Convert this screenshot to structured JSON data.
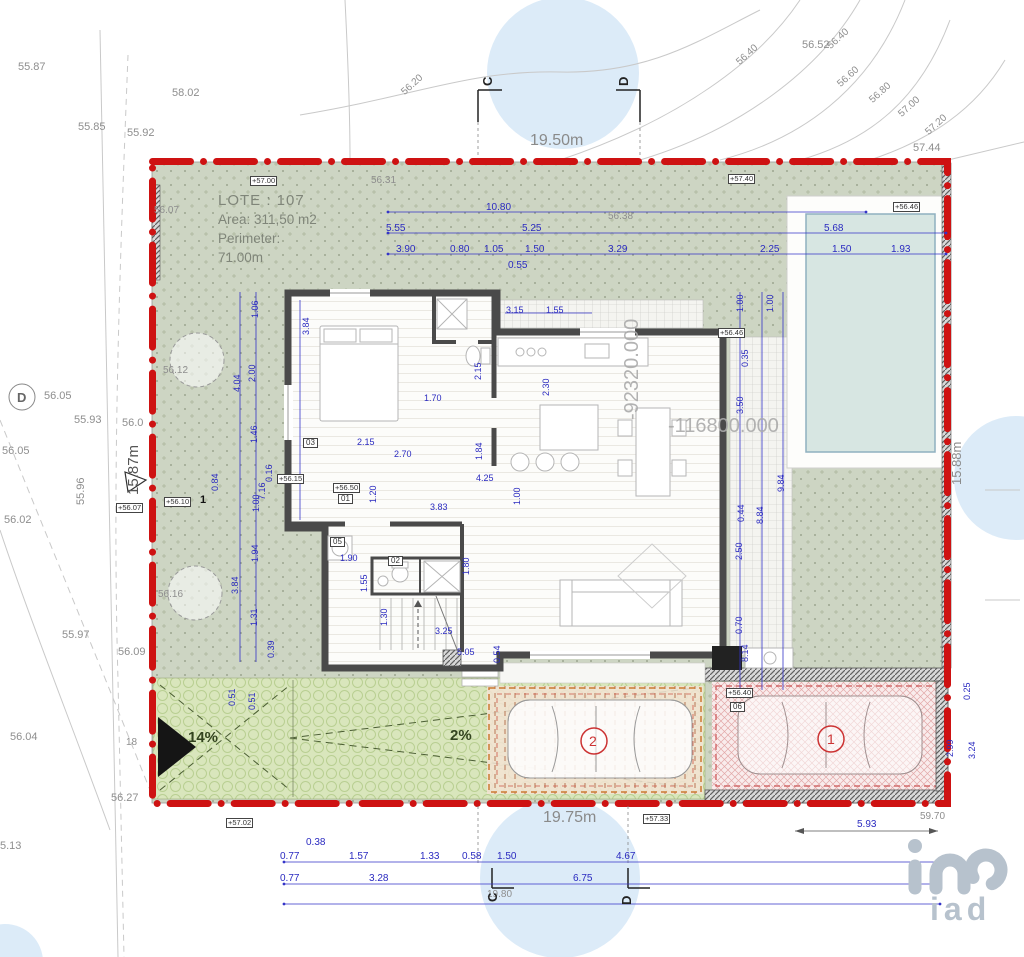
{
  "title": {
    "lote": "LOTE : 107",
    "area": "Area: 311,50 m2",
    "perimeter_label": "Perimeter:",
    "perimeter_value": "71.00m"
  },
  "boundary": {
    "top": "19.50m",
    "bottom": "19.75m",
    "left": "15.87m",
    "right": "15.88m",
    "d593": "5.93",
    "d5970": "59.70",
    "d1980": "19.80"
  },
  "coords": {
    "v": "-92320.000",
    "h": "-116800.000"
  },
  "sections": {
    "c": "C",
    "d": "D",
    "d_circle": "D"
  },
  "slopes": {
    "s14": "14%",
    "s2": "2%",
    "n18": "18"
  },
  "parking": {
    "p1": "1",
    "p2": "2"
  },
  "rooms": {
    "r01": "01",
    "r02": "02",
    "r03": "03",
    "r05": "05",
    "r06": "06"
  },
  "marks": {
    "m5700": "+57.00",
    "m5740": "+57.40",
    "m5646": "+56.46",
    "m5646b": "+56.46",
    "m5607": "+56.07",
    "m5610": "+56.10",
    "m5610n": "1",
    "m5615": "+56.15",
    "m5650": "+56.50",
    "m5640": "+56.40",
    "m5702": "+57.02",
    "m5733": "+57.33"
  },
  "elev": {
    "e5587": "55.87",
    "e5802": "58.02",
    "e5585": "55.85",
    "e5592": "55.92",
    "e5607": "56.07",
    "e5612": "56.12",
    "e5605a": "56.05",
    "e5593": "55.93",
    "e560": "56.0",
    "e5605b": "56.05",
    "e5602": "56.02",
    "e5596": "55.96",
    "e5616": "56.16",
    "e5597": "55.97",
    "e5609": "56.09",
    "e5604": "56.04",
    "e5627": "56.27",
    "e513": "5.13",
    "e5631": "56.31",
    "e5638": "56.38",
    "e5652": "56.52",
    "e5744": "57.44",
    "e5620": "56.20",
    "e5640a": "56.40",
    "e5640b": "56.40",
    "e5660": "56.60",
    "e5680": "56.80",
    "e5700": "57.00",
    "e5720": "57.20"
  },
  "dims_top": {
    "d1080": "10.80",
    "d555": "5.55",
    "d525": "5.25",
    "d568": "5.68",
    "d390": "3.90",
    "d080": "0.80",
    "d105": "1.05",
    "d150a": "1.50",
    "d329": "3.29",
    "d225": "2.25",
    "d150b": "1.50",
    "d193": "1.93",
    "d055": "0.55"
  },
  "dims_bottom": {
    "d038": "0.38",
    "d077a": "0.77",
    "d157": "1.57",
    "d133": "1.33",
    "d058": "0.58",
    "d150": "1.50",
    "d467": "4.67",
    "d077b": "0.77",
    "d328": "3.28",
    "d675": "6.75"
  },
  "dims_left": {
    "d106": "1.06",
    "d200": "2.00",
    "d404": "4.04",
    "d146": "1.46",
    "d016": "0.16",
    "d716": "7.16",
    "d100": "1.00",
    "d194": "1.94",
    "d384": "3.84",
    "d131": "1.31",
    "d039": "0.39",
    "d084": "0.84",
    "d051a": "0.51",
    "d051b": "0.51"
  },
  "dims_right": {
    "d100a": "1.00",
    "d100b": "1.00",
    "d035": "0.35",
    "d350": "3.50",
    "d044": "0.44",
    "d250": "2.50",
    "d884": "8.84",
    "d984": "9.84",
    "d070": "0.70",
    "d025": "0.25",
    "d299": "2.99",
    "d324": "3.24",
    "d814": "8.14"
  },
  "dims_house": {
    "d384": "3.84",
    "d315": "3.15",
    "d155": "1.55",
    "d230": "2.30",
    "d170": "1.70",
    "d215r": "2.15",
    "d215": "2.15",
    "d270": "2.70",
    "d184": "1.84",
    "d100": "1.00",
    "d383": "3.83",
    "d180": "1.80",
    "d190": "1.90",
    "d155r": "1.55",
    "d130": "1.30",
    "d325": "3.25",
    "d505": "5.05",
    "d054": "0.54",
    "d120": "1.20",
    "d425": "4.25"
  },
  "logo": {
    "text": "iad"
  },
  "colors": {
    "boundary_red": "#ce1212",
    "dim_blue": "#2a2ac0",
    "lot_green": "#cdd5c3",
    "drive_green": "#d9e6bc",
    "parking_pink": "#f9ecec",
    "pool_water": "#d7e6e2",
    "watermark_blue": "#dcebf8",
    "logo_gray": "#b7c2cd"
  }
}
